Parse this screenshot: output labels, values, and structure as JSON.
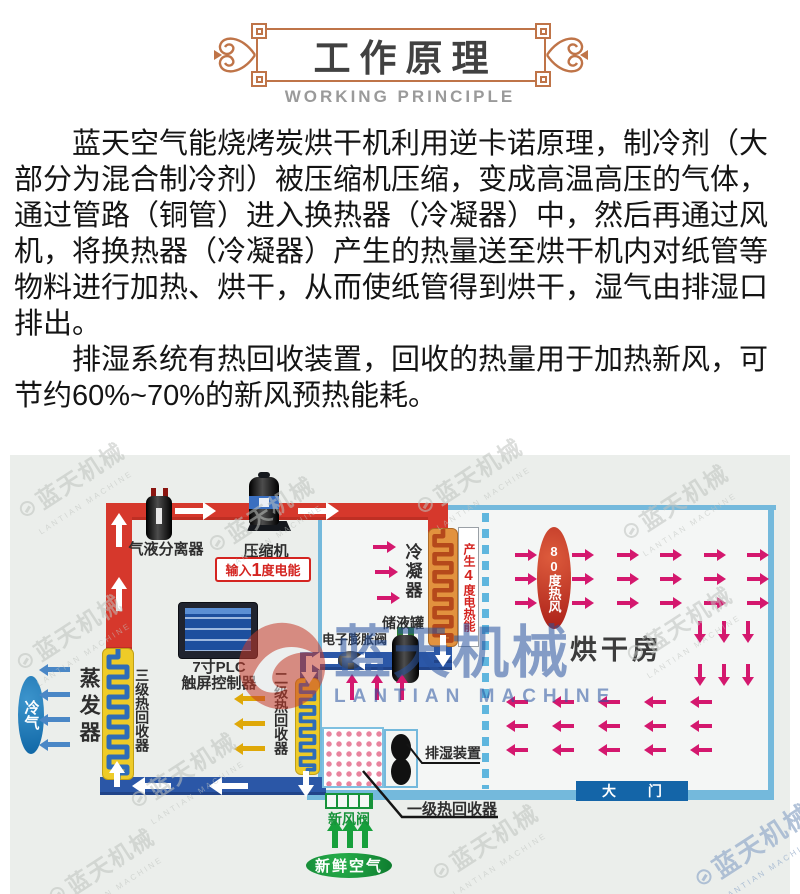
{
  "header": {
    "title": "工作原理",
    "subtitle": "WORKING PRINCIPLE"
  },
  "intro": {
    "p1": "蓝天空气能烧烤炭烘干机利用逆卡诺原理，制冷剂（大部分为混合制冷剂）被压缩机压缩，变成高温高压的气体，通过管路（铜管）进入换热器（冷凝器）中，然后再通过风机，将换热器（冷凝器）产生的热量送至烘干机内对纸管等物料进行加热、烘干，从而使纸管得到烘干，湿气由排湿口排出。",
    "p2": "排湿系统有热回收装置，回收的热量用于加热新风，可节约60%~70%的新风预热能耗。"
  },
  "diagram": {
    "labels": {
      "separator": "气液分离器",
      "compressor": "压缩机",
      "input_pre": "输入",
      "input_num": "1",
      "input_post": "度电能",
      "condenser": "冷凝器",
      "gen_pre": "产生",
      "gen_num": "4",
      "gen_post": "度电热能",
      "receiver": "储液罐",
      "expansion_valve": "电子膨胀阀",
      "plc_line1": "7寸PLC",
      "plc_line2": "触屏控制器",
      "evaporator": "蒸发器",
      "cold_air": "冷气",
      "recovery3": "三级热回收器",
      "recovery2": "二级热回收器",
      "recovery1": "一级热回收器",
      "dehumidifier": "排湿装置",
      "fresh_air_valve": "新风阀",
      "fresh_air": "新鲜空气",
      "hot_wind": "80度热风",
      "drying_room": "烘干房",
      "gate": "大 门"
    },
    "watermark": {
      "cn": "蓝天机械",
      "en": "LANTIAN MACHINE"
    },
    "colors": {
      "hot_pipe": "#d6382c",
      "cold_pipe": "#2b57a7",
      "room_border": "#74b9dc",
      "hot_air_arrow": "#d4186e",
      "heat_recovery_arrow": "#dfa808",
      "cold_air_arrow": "#4a87c6",
      "fresh_air_green": "#17a03c",
      "hot_wind_oval": "#c22b20",
      "gate_box": "#1465a8",
      "coil_yellow": "#eecb28",
      "coil_orange": "#e2923e",
      "ornament": "#bf7448"
    }
  }
}
